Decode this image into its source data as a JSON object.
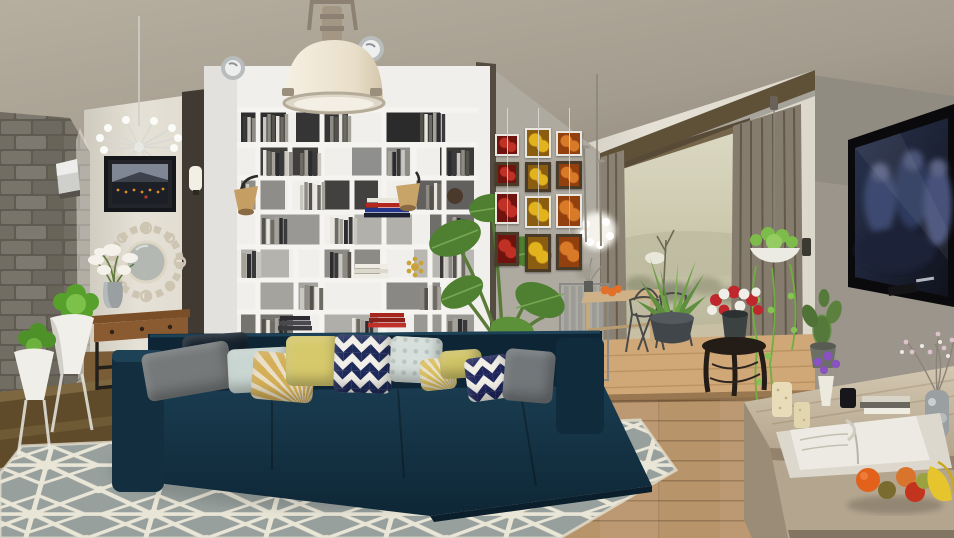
{
  "meta": {
    "description": "3D rendered modern open-plan living room with dining area",
    "room_style": "modern loft, two-level wood floor",
    "canvas": {
      "width": 954,
      "height": 538
    }
  },
  "palette": {
    "ceiling": "#aaa295",
    "wall_white": "#e2ded3",
    "wall_gray": "#9b958b",
    "art_wall_concrete": "#a9a59b",
    "stone_wall": "#6b675d",
    "bookshelf_white": "#f1efec",
    "sofa_navy": "#14303f",
    "rug_gray": "#99a19e",
    "rug_pattern_cream": "#eae6d7",
    "floor_wood": "#b8946a",
    "platform_bright_wood": "#d0a878",
    "dark_step_wood": "#5f4a2a",
    "curtain_taupe": "#8a8173",
    "window_frame_wood": "#6a5a40",
    "outside_landscape": "#cdc9ae",
    "tv_black": "#0a0a0c",
    "sideboard_oak": "#c4b7a1",
    "plant_green": "#5e9c37",
    "accent_yellow": "#d6c96c",
    "accent_red": "#b5271f",
    "accent_orange": "#d2691e"
  },
  "objects": {
    "pendant_lamp": {
      "label": "Industrial pendant lamp with cream dome shade"
    },
    "wall_spotlights": {
      "label": "Round chrome wall spotlights",
      "count": 2
    },
    "bookshelf": {
      "label": "Floor-to-ceiling white cube bookshelf"
    },
    "shelf_lamps": {
      "label": "Clamp-on shelf lamps with beige shades",
      "count": 2
    },
    "sputnik_chandelier": {
      "label": "Chrome sputnik chandelier"
    },
    "city_picture": {
      "label": "Framed night skyline picture"
    },
    "ornate_mirror": {
      "label": "Round ornate scrollwork mirror"
    },
    "console_table": {
      "label": "Industrial console table with drawers"
    },
    "lily_vase": {
      "label": "Gray vase with white lilies"
    },
    "stone_wall": {
      "label": "Stacked gray stone feature wall"
    },
    "stone_wall_sconce": {
      "label": "Metal wall sconce on stone wall"
    },
    "pillar_sconce": {
      "label": "White glass sconce on pillar"
    },
    "white_planters": {
      "label": "White goblet planters with green plants",
      "count": 2
    },
    "sofa": {
      "label": "Navy blue sectional sofa with chaise"
    },
    "rug": {
      "label": "Gray rug with cream starburst geometric pattern"
    },
    "alocasia_plant": {
      "label": "Tall leafy alocasia house plant"
    },
    "fruit_art": {
      "label": "Grid of hanging fruit photographs",
      "columns": 3,
      "rows": 4,
      "themes": [
        "red cherries",
        "yellow peaches",
        "orange apricots"
      ]
    },
    "dandelion_pendant": {
      "label": "Fluffy white pendant light over dining table"
    },
    "floor_lamp_poles": {
      "label": "Thin pole floor lamps",
      "count": 2
    },
    "dining_table": {
      "label": "Light wood dining table"
    },
    "dining_chairs": {
      "label": "Gray slatted and wire dining chairs",
      "count": 4
    },
    "table_fruit": {
      "label": "Orange fruit on dining table"
    },
    "table_twigs": {
      "label": "Dried twig bouquet on table"
    },
    "agave_plant": {
      "label": "Agave plant in round gray pot"
    },
    "glass_doors": {
      "label": "Wood framed glass doors to terrace"
    },
    "curtains": {
      "label": "Taupe floor-length curtains"
    },
    "outside_view": {
      "label": "Pale hilly landscape with shrubs and bare tree"
    },
    "hanging_plant": {
      "label": "Hanging white bowl planter with trailing vines"
    },
    "flower_stool": {
      "label": "Dark carved stool with red and white bouquet"
    },
    "cactus": {
      "label": "Paddle cactus in gray pot"
    },
    "tv": {
      "label": "Wall-mounted flat screen TV playing dark movie scene"
    },
    "sideboard": {
      "label": "Weathered oak low sideboard"
    },
    "sideboard_items": {
      "label": "Candles, open magazine, books, vases and fruit on sideboard"
    },
    "fruit_group": {
      "label": "Oranges, kiwi, pear and bananas"
    },
    "blossom_vase": {
      "label": "Marbled vase with blossom branches"
    },
    "purple_flower_vase": {
      "label": "White vase with purple flowers"
    }
  },
  "pillows": [
    {
      "name": "pillow-navy-back",
      "type": "solid",
      "x": 183,
      "y": 334,
      "w": 66,
      "h": 38,
      "rot": -4,
      "c1": "#16222e",
      "c2": ""
    },
    {
      "name": "pillow-gray-left",
      "type": "solid",
      "x": 144,
      "y": 347,
      "w": 88,
      "h": 48,
      "rot": -10,
      "c1": "#75797a",
      "c2": ""
    },
    {
      "name": "pillow-pale-blue",
      "type": "solid",
      "x": 228,
      "y": 348,
      "w": 64,
      "h": 44,
      "rot": -3,
      "c1": "#c9d6d2",
      "c2": ""
    },
    {
      "name": "pillow-cream-fan",
      "type": "fan",
      "x": 252,
      "y": 353,
      "w": 62,
      "h": 48,
      "rot": 5,
      "c1": "#d4af57",
      "c2": "#e9dfc6"
    },
    {
      "name": "pillow-yellow",
      "type": "solid",
      "x": 286,
      "y": 336,
      "w": 54,
      "h": 50,
      "rot": 0,
      "c1": "#d6c96c",
      "c2": ""
    },
    {
      "name": "pillow-chevron-large",
      "type": "chevron",
      "x": 334,
      "y": 335,
      "w": 58,
      "h": 58,
      "rot": 2,
      "c1": "#1e2a5a",
      "c2": "#f2f0e8"
    },
    {
      "name": "pillow-pale-pattern",
      "type": "dotpat",
      "x": 390,
      "y": 337,
      "w": 52,
      "h": 46,
      "rot": 3,
      "c1": "#d6dfdb",
      "c2": "#b9c6c1"
    },
    {
      "name": "pillow-cream-edge",
      "type": "fan",
      "x": 420,
      "y": 358,
      "w": 36,
      "h": 32,
      "rot": -6,
      "c1": "#dcc05e",
      "c2": "#e9e2cc"
    },
    {
      "name": "pillow-yellow-right",
      "type": "solid",
      "x": 440,
      "y": 350,
      "w": 42,
      "h": 28,
      "rot": -4,
      "c1": "#d2c567",
      "c2": ""
    },
    {
      "name": "pillow-chevron-small",
      "type": "chevron",
      "x": 466,
      "y": 356,
      "w": 46,
      "h": 44,
      "rot": -8,
      "c1": "#20265c",
      "c2": "#f1efe6"
    },
    {
      "name": "pillow-gray-right",
      "type": "solid",
      "x": 504,
      "y": 350,
      "w": 50,
      "h": 52,
      "rot": 5,
      "c1": "#72777a",
      "c2": ""
    }
  ],
  "art_grid": {
    "x": 495,
    "y": 128,
    "wire_top": 108,
    "columns": [
      {
        "dx": 0,
        "w": 24,
        "c1": "#c03125",
        "c2": "#6e130e",
        "frames": [
          {
            "dy": 6,
            "h": 22
          },
          {
            "dy": 34,
            "h": 24
          },
          {
            "dy": 64,
            "h": 32
          },
          {
            "dy": 104,
            "h": 34
          }
        ]
      },
      {
        "dx": 30,
        "w": 26,
        "c1": "#e3b31d",
        "c2": "#8a5d10",
        "frames": [
          {
            "dy": 0,
            "h": 30
          },
          {
            "dy": 34,
            "h": 30
          },
          {
            "dy": 68,
            "h": 32
          },
          {
            "dy": 106,
            "h": 38
          }
        ]
      },
      {
        "dx": 61,
        "w": 26,
        "c1": "#d87a28",
        "c2": "#93400f",
        "frames": [
          {
            "dy": 3,
            "h": 25
          },
          {
            "dy": 33,
            "h": 28
          },
          {
            "dy": 66,
            "h": 34
          },
          {
            "dy": 106,
            "h": 36
          }
        ]
      }
    ]
  },
  "bookshelf": {
    "spine_colors": [
      "#3a3a3a",
      "#cac7c0",
      "#8e8b84",
      "#55524c",
      "#e8e5de",
      "#6e6b64",
      "#a5a29a",
      "#2c2c30"
    ],
    "books": [
      {
        "x": 243,
        "y": 116,
        "w": 13,
        "h": 26
      },
      {
        "x": 263,
        "y": 114,
        "w": 26,
        "h": 28
      },
      {
        "x": 330,
        "y": 114,
        "w": 22,
        "h": 28
      },
      {
        "x": 420,
        "y": 112,
        "w": 26,
        "h": 30
      },
      {
        "x": 263,
        "y": 150,
        "w": 30,
        "h": 26
      },
      {
        "x": 300,
        "y": 150,
        "w": 22,
        "h": 26
      },
      {
        "x": 388,
        "y": 149,
        "w": 22,
        "h": 27
      },
      {
        "x": 448,
        "y": 150,
        "w": 22,
        "h": 26
      },
      {
        "x": 242,
        "y": 183,
        "w": 12,
        "h": 27
      },
      {
        "x": 300,
        "y": 182,
        "w": 26,
        "h": 28
      },
      {
        "x": 426,
        "y": 183,
        "w": 16,
        "h": 27
      },
      {
        "x": 262,
        "y": 217,
        "w": 26,
        "h": 27
      },
      {
        "x": 330,
        "y": 217,
        "w": 28,
        "h": 27
      },
      {
        "x": 448,
        "y": 217,
        "w": 18,
        "h": 27
      },
      {
        "x": 242,
        "y": 251,
        "w": 20,
        "h": 27
      },
      {
        "x": 330,
        "y": 251,
        "w": 22,
        "h": 27
      },
      {
        "x": 440,
        "y": 251,
        "w": 26,
        "h": 27
      },
      {
        "x": 300,
        "y": 285,
        "w": 24,
        "h": 25
      },
      {
        "x": 420,
        "y": 285,
        "w": 22,
        "h": 25
      },
      {
        "x": 262,
        "y": 318,
        "w": 26,
        "h": 25
      },
      {
        "x": 352,
        "y": 318,
        "w": 22,
        "h": 25
      },
      {
        "x": 448,
        "y": 318,
        "w": 20,
        "h": 25
      }
    ],
    "hstacks": [
      {
        "x": 367,
        "y": 198,
        "w": 40,
        "colors": [
          "#e8e5da",
          "#b3271f",
          "#24368a",
          "#1a2030"
        ]
      },
      {
        "x": 355,
        "y": 264,
        "w": 32,
        "colors": [
          "#efece3",
          "#dcd8cc",
          "#efece3"
        ]
      },
      {
        "x": 280,
        "y": 316,
        "w": 30,
        "colors": [
          "#2c2c30",
          "#4a4a4e",
          "#3a3a3e"
        ]
      },
      {
        "x": 370,
        "y": 313,
        "w": 34,
        "colors": [
          "#a8251e",
          "#8c1f1a",
          "#c03028"
        ]
      },
      {
        "x": 258,
        "y": 337,
        "w": 34,
        "colors": [
          "#d8d4c8",
          "#6a675f",
          "#efece2"
        ]
      }
    ]
  },
  "tv_screen": {
    "scene": "dark blue-toned movie frame with several figures",
    "caption_blur": "illegible white caption, bottom right"
  }
}
